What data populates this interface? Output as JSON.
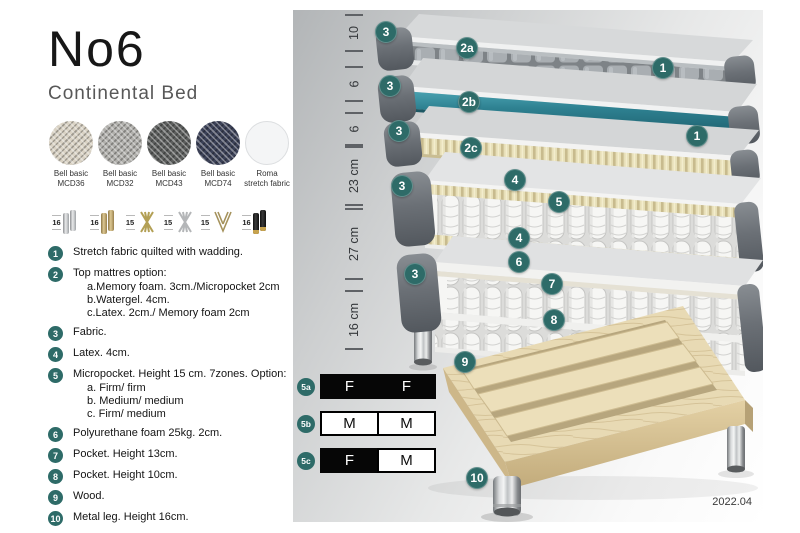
{
  "product": {
    "title": "No6",
    "subtitle": "Continental Bed"
  },
  "fabrics": [
    {
      "line1": "Bell basic",
      "line2": "MCD36"
    },
    {
      "line1": "Bell basic",
      "line2": "MCD32"
    },
    {
      "line1": "Bell basic",
      "line2": "MCD43"
    },
    {
      "line1": "Bell basic",
      "line2": "MCD74"
    },
    {
      "line1": "Roma",
      "line2": "stretch fabric"
    }
  ],
  "legs": [
    {
      "height": "16",
      "type": "cylinder-silver"
    },
    {
      "height": "16",
      "type": "cylinder-brass"
    },
    {
      "height": "15",
      "type": "crossed-gold"
    },
    {
      "height": "15",
      "type": "crossed-silver"
    },
    {
      "height": "15",
      "type": "hairpin"
    },
    {
      "height": "16",
      "type": "cylinder-black-gold"
    }
  ],
  "features": [
    {
      "num": "1",
      "text": "Stretch fabric quilted with wadding."
    },
    {
      "num": "2",
      "text": "Top mattres option:",
      "options": [
        "a.Memory foam. 3cm./Micropocket 2cm",
        "b.Watergel. 4cm.",
        "c.Latex. 2cm./ Memory foam 2cm"
      ]
    },
    {
      "num": "3",
      "text": "Fabric."
    },
    {
      "num": "4",
      "text": "Latex. 4cm."
    },
    {
      "num": "5",
      "text": "Micropocket. Height 15 cm. 7zones. Option:",
      "options": [
        "a. Firm/ firm",
        "b. Medium/ medium",
        "c. Firm/ medium"
      ]
    },
    {
      "num": "6",
      "text": "Polyurethane foam 25kg. 2cm."
    },
    {
      "num": "7",
      "text": "Pocket. Height 13cm."
    },
    {
      "num": "8",
      "text": "Pocket. Height 10cm."
    },
    {
      "num": "9",
      "text": "Wood."
    },
    {
      "num": "10",
      "text": "Metal leg. Height 16cm."
    }
  ],
  "diagram": {
    "dimensions": [
      "10",
      "6",
      "6",
      "23 cm",
      "27 cm",
      "16 cm"
    ],
    "badges": [
      "3",
      "2a",
      "1",
      "3",
      "2b",
      "3",
      "2c",
      "1",
      "3",
      "4",
      "5",
      "4",
      "6",
      "3",
      "7",
      "8",
      "9",
      "10"
    ],
    "firmness": [
      {
        "id": "5a",
        "cells": [
          {
            "t": "F"
          },
          {
            "t": "F"
          }
        ]
      },
      {
        "id": "5b",
        "cells": [
          {
            "t": "M"
          },
          {
            "t": "M"
          }
        ]
      },
      {
        "id": "5c",
        "cells": [
          {
            "t": "F"
          },
          {
            "t": "M"
          }
        ]
      }
    ],
    "version": "2022.04"
  },
  "colors": {
    "accent_teal_badge": "#2e6b68",
    "watergel_layer": "#2e8191",
    "latex_cream": "#e7dfb8",
    "wood": "#e8dab4"
  }
}
